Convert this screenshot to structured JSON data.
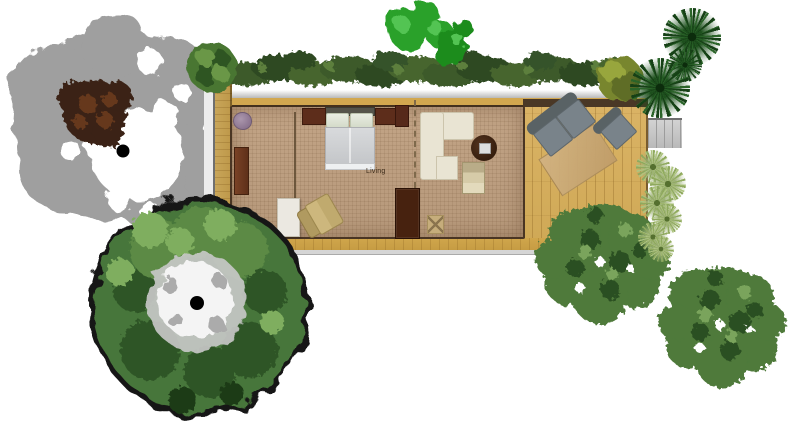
{
  "scene": {
    "type": "garden-floor-plan-render",
    "room_label": "Living",
    "building": {
      "areas": [
        "side-walkway",
        "living-bedroom-room",
        "wood-deck",
        "entry-steps"
      ],
      "colors": {
        "carpet": "#bfa183",
        "deck_wood": "#d8b161",
        "walkway_wood": "#c9a65a",
        "roof_gutter": "#c6c6c6",
        "top_plate_gold": "#d2a74f",
        "wall_dark": "#43301d",
        "stairs_gray": "#c3c3c3"
      },
      "furniture": [
        "double-bed",
        "nightstand-left",
        "nightstand-right",
        "purple-pouf",
        "wall-desk",
        "white-side-table",
        "tan-armchair",
        "ceiling-fan-symbol",
        "sliding-partition",
        "sectional-sofa",
        "round-coffee-table",
        "lounge-chair",
        "wardrobe",
        "small-cabinet",
        "ottoman",
        "outdoor-sofa",
        "outdoor-armchair",
        "outdoor-rug"
      ],
      "furniture_colors": {
        "bed_duvet": "#d2d4d6",
        "dark_wood_furniture": "#5d2d1b",
        "outdoor_sofa_gray": "#79838a",
        "outdoor_rug_tan": "#c9a977",
        "sectional_cream": "#e9e4d3"
      }
    },
    "vegetation": {
      "items": [
        "gray-tree-canopy",
        "brown-tree-crown",
        "big-green-tree",
        "hedge-row",
        "small-green-bush",
        "bright-green-shrubs",
        "olive-round-bush",
        "dark-palm-cluster",
        "light-palm-rosettes",
        "leafy-tree-lower",
        "leafy-tree-right"
      ],
      "colors": {
        "gray_canopy": "#9f9f9f",
        "crown_brown": "#3a2314",
        "big_tree_green": "#47763a",
        "big_tree_outline": "#141414",
        "hedge_green": "#3c5a2b",
        "bright_shrub": "#2aa12a",
        "olive_bush": "#78862f",
        "palm_dark": "#1d4f1d",
        "palm_light": "#9db177",
        "leafy_tree": "#4f7a3b"
      }
    }
  }
}
